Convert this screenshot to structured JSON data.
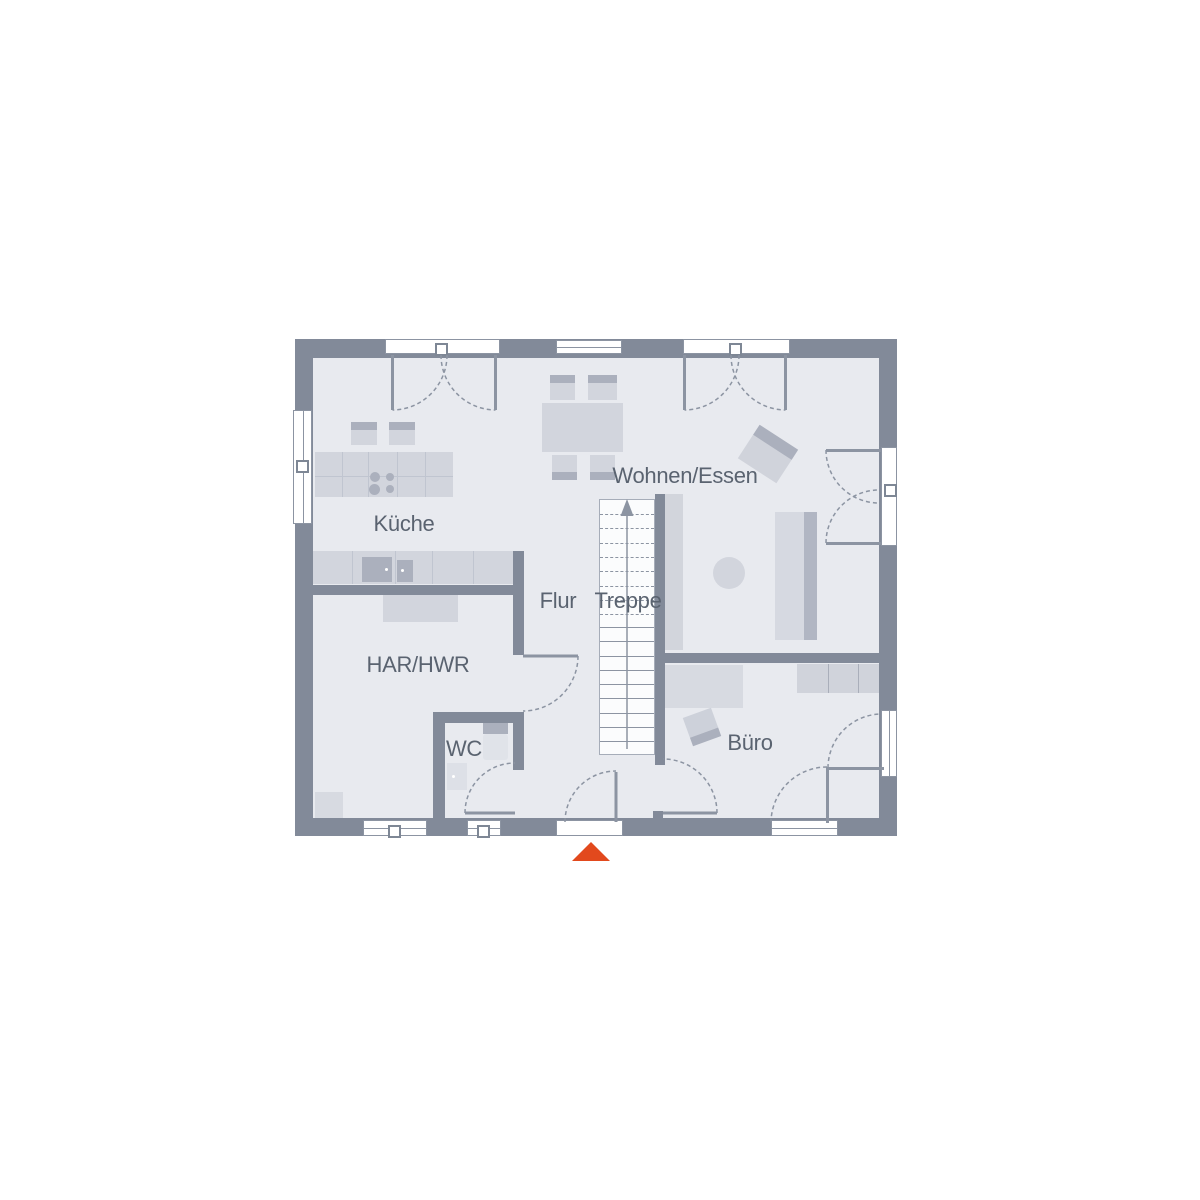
{
  "labels": {
    "kueche": "Küche",
    "wohnen_essen": "Wohnen/Essen",
    "flur": "Flur",
    "treppe": "Treppe",
    "har_hwr": "HAR/HWR",
    "wc": "WC",
    "buero": "Büro"
  },
  "rooms": [
    {
      "id": "kueche",
      "label": "Küche"
    },
    {
      "id": "wohnen_essen",
      "label": "Wohnen/Essen"
    },
    {
      "id": "flur",
      "label": "Flur"
    },
    {
      "id": "treppe",
      "label": "Treppe"
    },
    {
      "id": "har_hwr",
      "label": "HAR/HWR"
    },
    {
      "id": "wc",
      "label": "WC"
    },
    {
      "id": "buero",
      "label": "Büro"
    }
  ],
  "stairs": {
    "direction": "up",
    "dashed_treads": 8,
    "solid_treads": 9
  },
  "entrance": {
    "marker": "up-triangle"
  },
  "colors": {
    "wall": "#828A99",
    "floor": "#E8EAEF",
    "line": "#8C94A2",
    "furniture_light": "#D2D5DD",
    "furniture_mid": "#C8CCD5",
    "furniture_dark": "#ABB0BD",
    "text": "#5A6370",
    "entrance_arrow": "#E2491D",
    "window_white": "#FFFFFF",
    "stair_bg": "#FBFCFD"
  }
}
